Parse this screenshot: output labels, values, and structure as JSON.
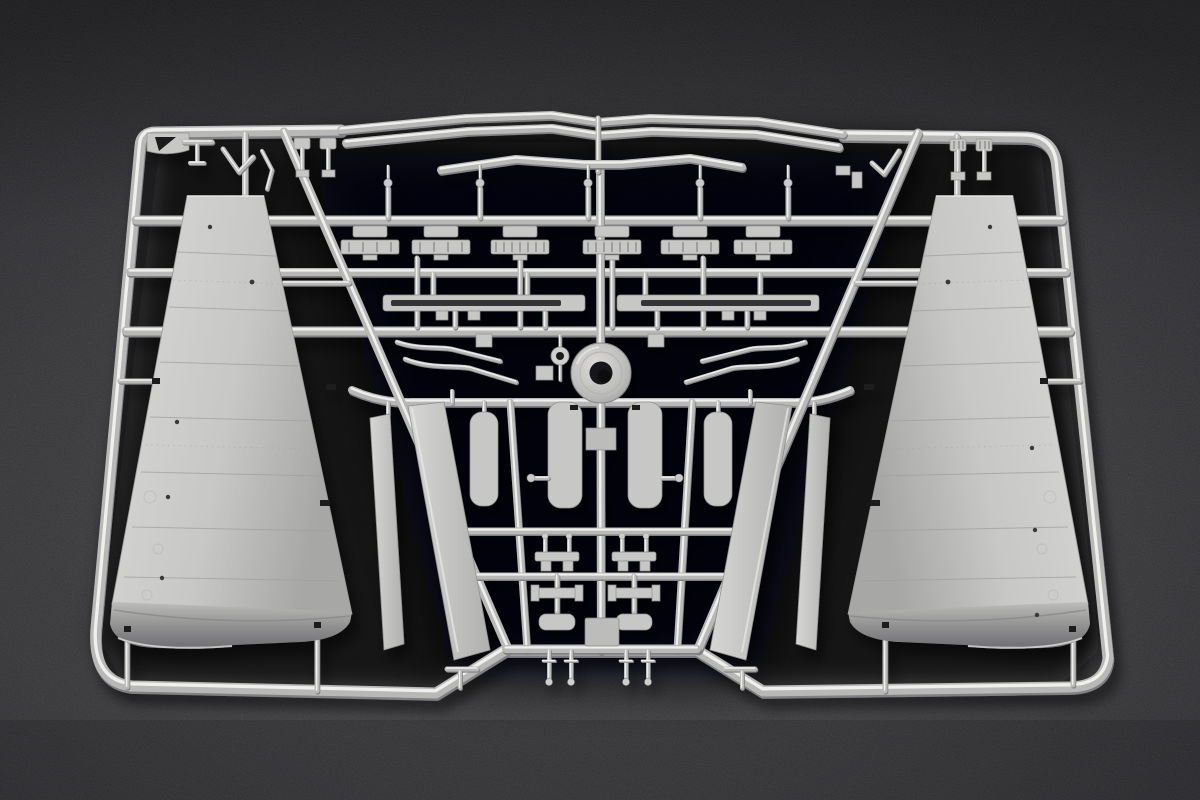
{
  "scene": {
    "type": "photograph",
    "subject": "Plastic model kit sprue with aircraft wing parts on a dark gray backdrop",
    "material": "light gray injection-molded polystyrene",
    "backdrop": "dark speckled gray felt",
    "gate_mark": "triangle"
  },
  "colors": {
    "bg_hi": "#5b5b5f",
    "bg_mid": "#47474b",
    "bg_lo": "#35353a",
    "bg_corner": "#26262a",
    "shadow_core": "#0a0a0d",
    "plastic": "#b8b8b6",
    "plastic_hi": "#efefed",
    "plastic_lo": "#7f7f84",
    "wing_hi": "#d9d9d7",
    "wing": "#c7c7c5",
    "wing_lo": "#a7a7a5",
    "panel_line": "#9f9f9d",
    "detail_dark": "#39393b",
    "gate_dark": "#1c1c1f"
  },
  "parts": [
    {
      "name": "outer-frame-runner",
      "count": 1,
      "desc": "rounded runner frame, notched at bottom center"
    },
    {
      "name": "wing-panel",
      "count": 2,
      "desc": "large tapered wing halves with engraved panel lines"
    },
    {
      "name": "leading-edge-slat",
      "count": 2,
      "desc": "full-width wavy slat strips along the top"
    },
    {
      "name": "short-slat",
      "count": 1,
      "desc": "shorter wavy strip below the slat pair"
    },
    {
      "name": "flap-strip",
      "count": 4,
      "desc": "long angled flap strips flanking the center"
    },
    {
      "name": "small-door",
      "count": 2,
      "desc": "short rounded door strips"
    },
    {
      "name": "gear-door",
      "count": 2,
      "desc": "rounded gear-bay doors at sprue center"
    },
    {
      "name": "actuator-bracket",
      "count": 6,
      "desc": "ribbed actuator brackets on the upper runner"
    },
    {
      "name": "mounting-pin",
      "count": 5,
      "desc": "tapered pins above the upper runner"
    },
    {
      "name": "slotted-rail",
      "count": 2,
      "desc": "thin slotted rails mid-sprue"
    },
    {
      "name": "control-rod",
      "count": 4,
      "desc": "bent control rods"
    },
    {
      "name": "wheel-hub",
      "count": 1,
      "desc": "round hub with dark center hole"
    },
    {
      "name": "small-ring",
      "count": 1,
      "desc": "small ring part beside the hub"
    },
    {
      "name": "hinge-fitting",
      "count": 8,
      "desc": "small hinge fittings in the lower grid"
    },
    {
      "name": "hanging-pin",
      "count": 4,
      "desc": "small pins below the lower runner"
    }
  ]
}
